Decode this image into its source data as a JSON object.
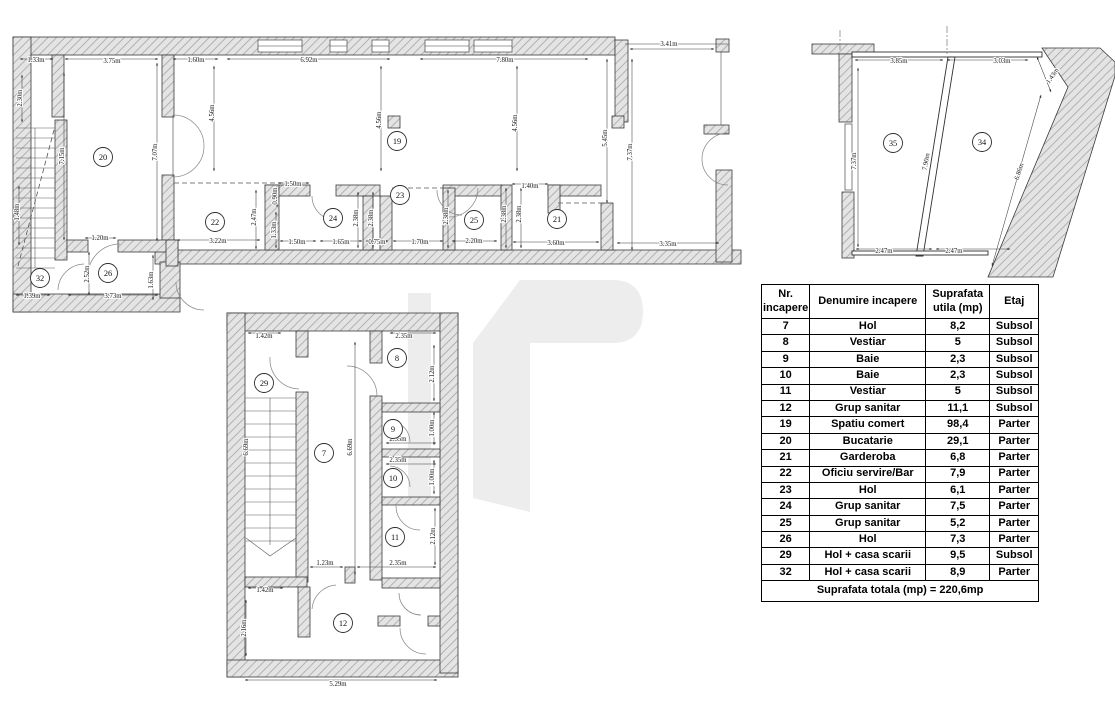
{
  "table": {
    "headers": [
      "Nr. incapere",
      "Denumire incapere",
      "Suprafata utila (mp)",
      "Etaj"
    ],
    "rows": [
      {
        "nr": "7",
        "name": "Hol",
        "area": "8,2",
        "floor": "Subsol"
      },
      {
        "nr": "8",
        "name": "Vestiar",
        "area": "5",
        "floor": "Subsol"
      },
      {
        "nr": "9",
        "name": "Baie",
        "area": "2,3",
        "floor": "Subsol"
      },
      {
        "nr": "10",
        "name": "Baie",
        "area": "2,3",
        "floor": "Subsol"
      },
      {
        "nr": "11",
        "name": "Vestiar",
        "area": "5",
        "floor": "Subsol"
      },
      {
        "nr": "12",
        "name": "Grup sanitar",
        "area": "11,1",
        "floor": "Subsol"
      },
      {
        "nr": "19",
        "name": "Spatiu comert",
        "area": "98,4",
        "floor": "Parter"
      },
      {
        "nr": "20",
        "name": "Bucatarie",
        "area": "29,1",
        "floor": "Parter"
      },
      {
        "nr": "21",
        "name": "Garderoba",
        "area": "6,8",
        "floor": "Parter"
      },
      {
        "nr": "22",
        "name": "Oficiu servire/Bar",
        "area": "7,9",
        "floor": "Parter"
      },
      {
        "nr": "23",
        "name": "Hol",
        "area": "6,1",
        "floor": "Parter"
      },
      {
        "nr": "24",
        "name": "Grup sanitar",
        "area": "7,5",
        "floor": "Parter"
      },
      {
        "nr": "25",
        "name": "Grup sanitar",
        "area": "5,2",
        "floor": "Parter"
      },
      {
        "nr": "26",
        "name": "Hol",
        "area": "7,3",
        "floor": "Parter"
      },
      {
        "nr": "29",
        "name": "Hol + casa scarii",
        "area": "9,5",
        "floor": "Subsol"
      },
      {
        "nr": "32",
        "name": "Hol + casa scarii",
        "area": "8,9",
        "floor": "Parter"
      }
    ],
    "total": "Suprafata totala (mp) = 220,6mp"
  },
  "plans": {
    "parter": {
      "rooms": [
        "20",
        "19",
        "22",
        "24",
        "23",
        "25",
        "21",
        "26",
        "32"
      ],
      "dims": [
        "1.33m",
        "3.75m",
        "1.60m",
        "6.92m",
        "7.80m",
        "3.41m",
        "2.30m",
        "7.15m",
        "1.48m",
        "7.07m",
        "4.56m",
        "4.56m",
        "4.56m",
        "5.45m",
        "7.37m",
        "1.20m",
        "2.52m",
        "1.63m",
        "1.39m",
        "3.73m",
        "3.22m",
        "1.50m",
        "1.65m",
        "0.75m",
        "1.70m",
        "2.20m",
        "3.60m",
        "3.35m",
        "2.47m",
        "0.90m",
        "1.33m",
        "2.38m",
        "2.38m",
        "2.38m",
        "2.38m",
        "2.38m",
        "1.50m",
        "1.40m"
      ]
    },
    "etaj": {
      "rooms": [
        "35",
        "34"
      ],
      "dims": [
        "3.85m",
        "3.03m",
        "1.43m",
        "7.37m",
        "7.90m",
        "6.86m",
        "2.47m",
        "2.47m"
      ]
    },
    "subsol": {
      "rooms": [
        "29",
        "7",
        "8",
        "9",
        "10",
        "11",
        "12"
      ],
      "dims": [
        "1.42m",
        "2.35m",
        "2.12m",
        "1.00m",
        "2.35m",
        "2.35m",
        "1.00m",
        "2.12m",
        "2.35m",
        "1.23m",
        "1.42m",
        "2.16m",
        "5.29m",
        "6.69m",
        "6.69m"
      ]
    }
  },
  "colors": {
    "wall_fill": "#e4e4e4",
    "hatch_line": "#a8a8a8",
    "outline": "#3b3b3b",
    "watermark": "#ededed"
  }
}
